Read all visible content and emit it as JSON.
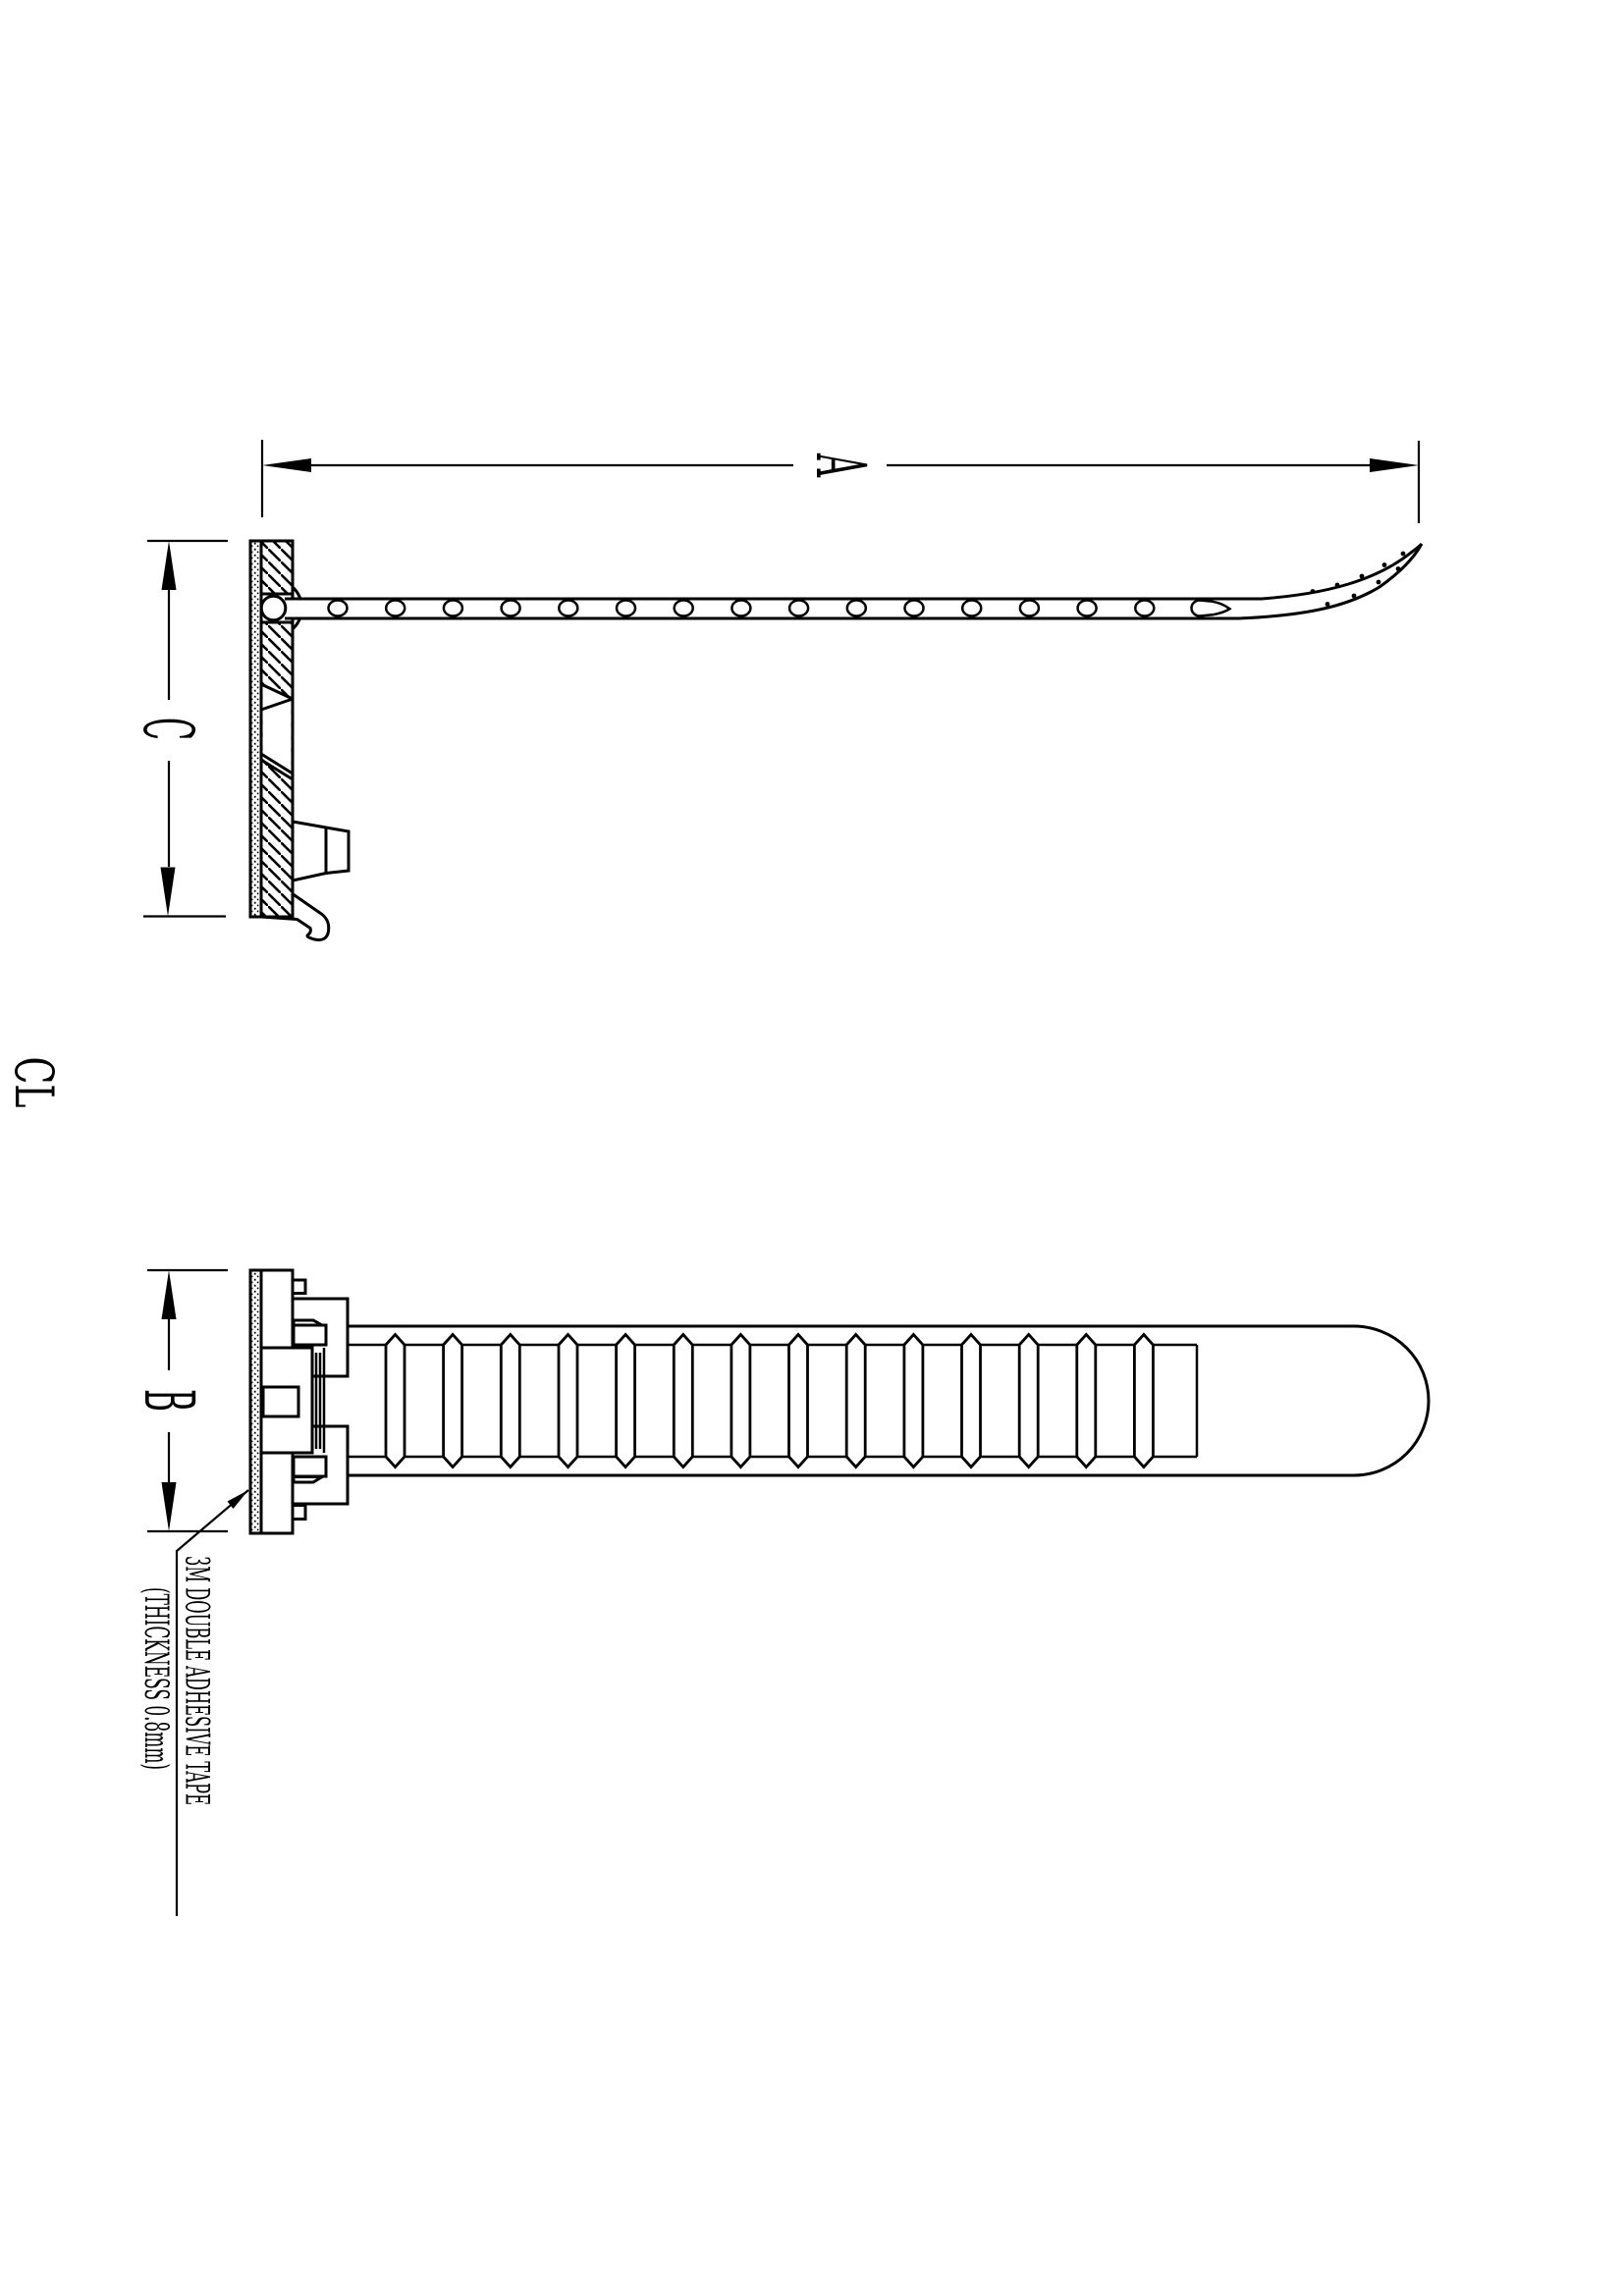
{
  "sheet": {
    "background_color": "#ffffff",
    "line_color": "#000000",
    "centerline_label": "CL"
  },
  "dimensions": {
    "overall_length_label": "A",
    "mount_height_label": "C",
    "mount_width_label": "B"
  },
  "note": {
    "line1": "3M DOUBLE ADHESIVE TAPE",
    "line2": "(THICKNESS 0.8mm)"
  }
}
